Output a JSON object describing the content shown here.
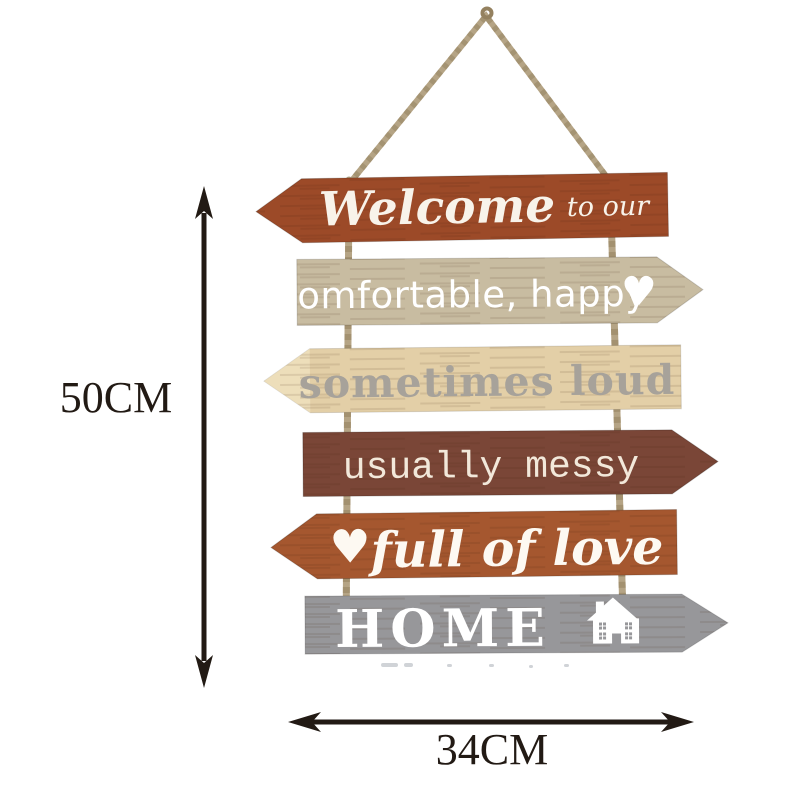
{
  "product_image": {
    "description_name": "hanging-wooden-arrow-sign",
    "background": "#ffffff",
    "sign": {
      "rope_color": "#b5a485",
      "rope_shade_color": "#94815f",
      "planks": [
        {
          "name": "welcome",
          "direction": "left",
          "color": "#9c4a28",
          "text_color": "#f8f3ea",
          "text_main": "Welcome",
          "text_suffix": "to our"
        },
        {
          "name": "comfortable-happy",
          "direction": "right",
          "color": "#c8bca1",
          "text_color": "#ffffff",
          "text": "comfortable, happy",
          "heart": "♥"
        },
        {
          "name": "sometimes-loud",
          "direction": "left",
          "color": "#e3cfa7",
          "tip_color": "#f0e3c0",
          "text_color": "#a7a29a",
          "text": "sometimes loud"
        },
        {
          "name": "usually-messy",
          "direction": "right",
          "color": "#7a4637",
          "text_color": "#f2e8da",
          "text": "usually messy"
        },
        {
          "name": "full-of-love",
          "direction": "left",
          "color": "#a5572f",
          "text_color": "#fdf9f2",
          "text": "full of love",
          "heart": "♥"
        },
        {
          "name": "home",
          "direction": "right",
          "color": "#97979a",
          "text_color": "#ffffff",
          "text": "HOME",
          "icon": "house"
        }
      ]
    },
    "dimensions": {
      "line_color": "#221a14",
      "height": {
        "label": "50CM"
      },
      "width": {
        "label": "34CM"
      }
    }
  }
}
